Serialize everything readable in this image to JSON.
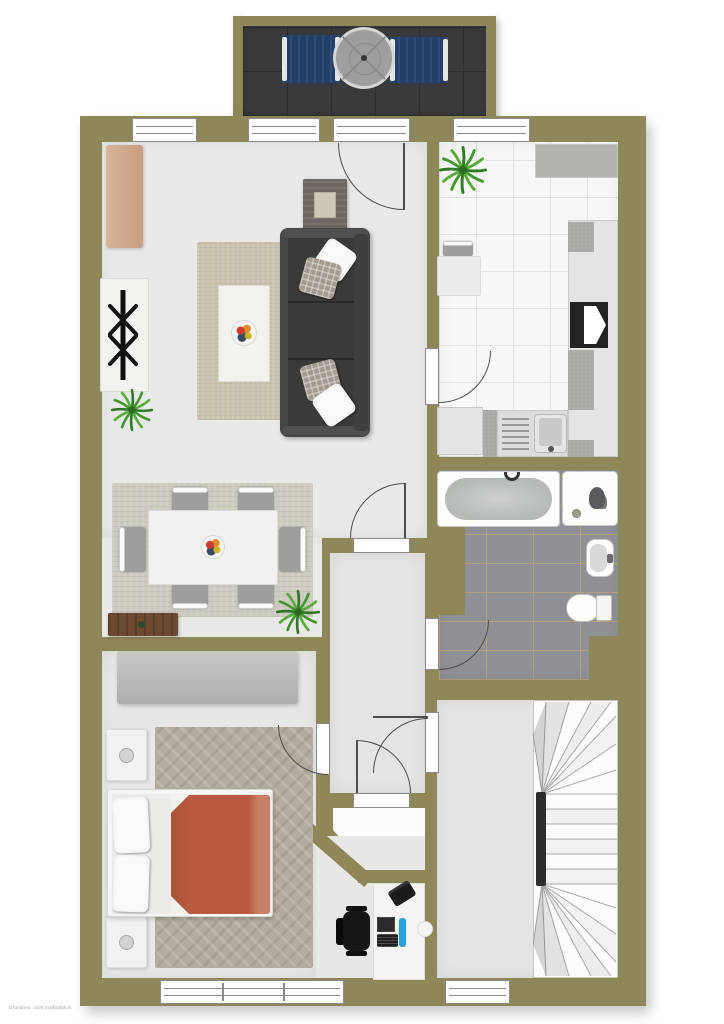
{
  "watermark": "Grundriss, nicht maßstäblich",
  "colors": {
    "wall": "#8e8758",
    "floor_living": "#e9e9e7",
    "floor_hall": "#e4e4e2",
    "floor_bedroom": "#e7e7e5",
    "floor_vestibule": "#fcfcfb",
    "kitchen_tile": "#f7f7f6",
    "kitchen_grout": "#e2e2e0",
    "bath_tile": "#909196",
    "bath_grout": "#b2a27c",
    "balcony_floor": "#3a3a3c",
    "balcony_grid": "#2d2d2f",
    "lounger": "#23406a",
    "parasol": "#9e9e9e",
    "sofa_body": "#474644",
    "sofa_seat": "#3b3a38",
    "rug_living": "#c9c2ae",
    "rug_dining": "#cdcac0",
    "rug_bedroom": "#b2ab9e",
    "coffee_table": "#f3f2ee",
    "dresser": "#d3a786",
    "wood": "#6d4a2f",
    "wardrobe": "#b9b9b7",
    "blanket": "#b85a3d",
    "chair_gray": "#9e9e9c",
    "counter": "#e4e4e2",
    "counter_dark": "#b5b3ad",
    "speckle": "#a9a9a5",
    "stove": "#232323",
    "water": "#b5bab5",
    "desk": "#f4f4f2",
    "office_chair": "#161616",
    "monitor": "#2b2b2d",
    "bottle": "#2d9fd6",
    "tv_unit": "#f2f2f0",
    "bed_white": "#f5f5f3",
    "door_line": "#4d4d4d",
    "frame": "#8a8a8a",
    "stair_spine": "#2e2e2e",
    "watermark_color": "#9b9b9b"
  },
  "rooms": [
    {
      "name": "balcony",
      "furniture": [
        "sun-lounger",
        "parasol-table",
        "sun-lounger"
      ]
    },
    {
      "name": "living-room",
      "furniture": [
        "dresser",
        "tv-lowboard",
        "tv",
        "plant",
        "rug",
        "coffee-table",
        "fruit-bowl",
        "sofa",
        "pillows",
        "side-table"
      ]
    },
    {
      "name": "dining-area",
      "furniture": [
        "rug",
        "dining-table",
        "fruit-bowl",
        "chair",
        "chair",
        "chair",
        "chair",
        "chair",
        "chair",
        "sideboard",
        "plant"
      ]
    },
    {
      "name": "kitchen",
      "furniture": [
        "plant",
        "small-table",
        "chair",
        "corner-counter",
        "counter",
        "stove",
        "sink",
        "drainboard"
      ]
    },
    {
      "name": "bathroom",
      "furniture": [
        "bathtub",
        "shower",
        "washbasin",
        "toilet"
      ]
    },
    {
      "name": "hallway",
      "furniture": []
    },
    {
      "name": "storage-closet",
      "furniture": []
    },
    {
      "name": "bedroom",
      "furniture": [
        "wardrobe",
        "rug",
        "double-bed",
        "nightstand",
        "nightstand",
        "desk",
        "office-chair",
        "monitor",
        "keyboard",
        "phone"
      ]
    },
    {
      "name": "stair-hall",
      "furniture": [
        "winder-staircase"
      ]
    }
  ]
}
